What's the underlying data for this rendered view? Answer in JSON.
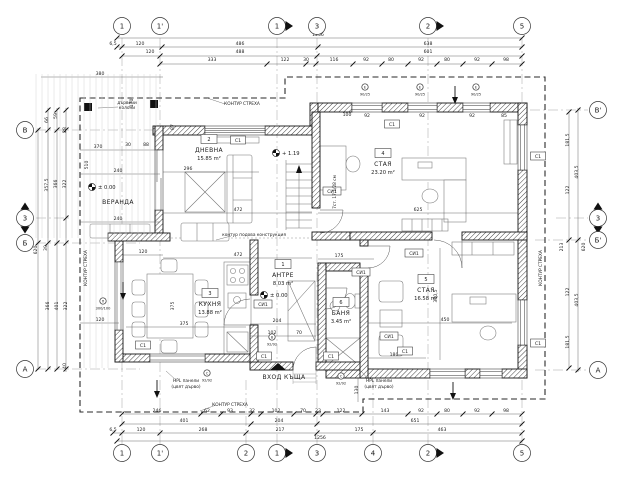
{
  "colors": {
    "paper": "#ffffff",
    "ink": "#1a1a1a"
  },
  "labels": {
    "veranda": "ВЕРАНДА",
    "entrance": "ВХОД КЪЩА",
    "c1": "С1",
    "si1": "СИ1"
  },
  "rooms": [
    {
      "num": "2",
      "name": "ДНЕВНА",
      "area": "15.85 m²",
      "x": 209,
      "y": 141
    },
    {
      "num": "4",
      "name": "СТАЯ",
      "area": "23.20 m²",
      "x": 383,
      "y": 155
    },
    {
      "num": "3",
      "name": "КУХНЯ",
      "area": "13.88 m²",
      "x": 210,
      "y": 295
    },
    {
      "num": "1",
      "name": "АНТРЕ",
      "area": "8.03 m²",
      "x": 283,
      "y": 266
    },
    {
      "num": "6",
      "name": "БАНЯ",
      "area": "3.45 m²",
      "x": 341,
      "y": 304
    },
    {
      "num": "5",
      "name": "СТАЯ",
      "area": "16.58 m²",
      "x": 426,
      "y": 281
    }
  ],
  "axes": {
    "top": [
      {
        "l": "1",
        "x": 122
      },
      {
        "l": "1'",
        "x": 160
      },
      {
        "l": "1",
        "x": 277,
        "s": "h"
      },
      {
        "l": "3",
        "x": 317
      },
      {
        "l": "2",
        "x": 428,
        "s": "h"
      },
      {
        "l": "5",
        "x": 522
      }
    ],
    "bottom": [
      {
        "l": "1",
        "x": 122
      },
      {
        "l": "1'",
        "x": 160
      },
      {
        "l": "2",
        "x": 246
      },
      {
        "l": "1",
        "x": 277,
        "s": "h"
      },
      {
        "l": "3",
        "x": 317
      },
      {
        "l": "4",
        "x": 373
      },
      {
        "l": "2",
        "x": 428,
        "s": "h"
      },
      {
        "l": "5",
        "x": 522
      }
    ],
    "left": [
      {
        "l": "В",
        "y": 130
      },
      {
        "l": "3",
        "y": 218,
        "s": "v"
      },
      {
        "l": "Б",
        "y": 243
      },
      {
        "l": "А",
        "y": 369
      }
    ],
    "right": [
      {
        "l": "В'",
        "y": 110
      },
      {
        "l": "3",
        "y": 218,
        "s": "v"
      },
      {
        "l": "Б'",
        "y": 240
      },
      {
        "l": "А",
        "y": 370
      }
    ]
  },
  "levels": [
    {
      "t": "± 0.00",
      "x": 104,
      "y": 189
    },
    {
      "t": "± 0.00",
      "x": 276,
      "y": 297
    },
    {
      "t": "+ 1.19",
      "x": 288,
      "y": 155
    }
  ],
  "boxes": {
    "c1": [
      [
        238,
        141
      ],
      [
        392,
        125
      ],
      [
        538,
        157
      ],
      [
        538,
        344
      ],
      [
        143,
        346
      ],
      [
        264,
        357
      ],
      [
        331,
        357
      ],
      [
        405,
        352
      ]
    ],
    "si1": [
      [
        332,
        192
      ],
      [
        263,
        305
      ],
      [
        361,
        273
      ],
      [
        389,
        337
      ],
      [
        414,
        254
      ]
    ]
  },
  "tags": [
    {
      "l": "Е",
      "n": "90/25",
      "x": 365,
      "y": 91
    },
    {
      "l": "Е",
      "n": "90/25",
      "x": 420,
      "y": 91
    },
    {
      "l": "Е",
      "n": "90/25",
      "x": 476,
      "y": 91
    },
    {
      "l": "В",
      "n": "92/92",
      "x": 272,
      "y": 341
    },
    {
      "l": "С",
      "n": "92/92",
      "x": 207,
      "y": 377
    },
    {
      "l": "С",
      "n": "92/92",
      "x": 341,
      "y": 380
    },
    {
      "l": "П",
      "n": "300/100",
      "x": 103,
      "y": 305
    }
  ],
  "annotations": [
    {
      "t": "КОНТУР СТРЕХА",
      "x": 242,
      "y": 105
    },
    {
      "t": "КОНТУР СТРЕХА",
      "x": 230,
      "y": 406
    },
    {
      "t": "КОНТУР СТРЕХА",
      "x": 87,
      "y": 268,
      "r": -90
    },
    {
      "t": "КОНТУР СТРЕХА",
      "x": 542,
      "y": 268,
      "r": -90
    },
    {
      "t": "контур подова конструкция",
      "x": 254,
      "y": 236
    },
    {
      "t": "дървени",
      "x": 127,
      "y": 104
    },
    {
      "t": "колони",
      "x": 127,
      "y": 109
    },
    {
      "t": "HPL панели",
      "x": 186,
      "y": 382
    },
    {
      "t": "(цвят дърво)",
      "x": 186,
      "y": 388
    },
    {
      "t": "HPL панели",
      "x": 379,
      "y": 382
    },
    {
      "t": "(цвят дърво)",
      "x": 379,
      "y": 388
    },
    {
      "t": "7ст. 17.1/28 см",
      "x": 336,
      "y": 192,
      "r": -90
    }
  ],
  "dims": [
    {
      "t": "1256",
      "x": 318,
      "y": 36
    },
    {
      "t": "6,5",
      "x": 113,
      "y": 45
    },
    {
      "t": "120",
      "x": 140,
      "y": 45
    },
    {
      "t": "486",
      "x": 240,
      "y": 45
    },
    {
      "t": "638",
      "x": 428,
      "y": 45
    },
    {
      "t": "120",
      "x": 150,
      "y": 53
    },
    {
      "t": "488",
      "x": 240,
      "y": 53
    },
    {
      "t": "601",
      "x": 428,
      "y": 53
    },
    {
      "t": "333",
      "x": 212,
      "y": 61
    },
    {
      "t": "122",
      "x": 285,
      "y": 61
    },
    {
      "t": "30",
      "x": 306,
      "y": 61
    },
    {
      "t": "116",
      "x": 334,
      "y": 61
    },
    {
      "t": "92",
      "x": 366,
      "y": 61
    },
    {
      "t": "80",
      "x": 391,
      "y": 61
    },
    {
      "t": "92",
      "x": 421,
      "y": 61
    },
    {
      "t": "80",
      "x": 447,
      "y": 61
    },
    {
      "t": "92",
      "x": 477,
      "y": 61
    },
    {
      "t": "98",
      "x": 506,
      "y": 61
    },
    {
      "t": "246",
      "x": 157,
      "y": 412
    },
    {
      "t": "62",
      "x": 207,
      "y": 412
    },
    {
      "t": "93",
      "x": 230,
      "y": 412
    },
    {
      "t": "32",
      "x": 252,
      "y": 412
    },
    {
      "t": "102",
      "x": 276,
      "y": 412
    },
    {
      "t": "70",
      "x": 303,
      "y": 412
    },
    {
      "t": "23",
      "x": 318,
      "y": 412
    },
    {
      "t": "122",
      "x": 341,
      "y": 412
    },
    {
      "t": "143",
      "x": 385,
      "y": 412
    },
    {
      "t": "92",
      "x": 421,
      "y": 412
    },
    {
      "t": "80",
      "x": 447,
      "y": 412
    },
    {
      "t": "92",
      "x": 477,
      "y": 412
    },
    {
      "t": "98",
      "x": 506,
      "y": 412
    },
    {
      "t": "401",
      "x": 184,
      "y": 422
    },
    {
      "t": "204",
      "x": 279,
      "y": 422
    },
    {
      "t": "651",
      "x": 415,
      "y": 422
    },
    {
      "t": "6,5",
      "x": 113,
      "y": 431
    },
    {
      "t": "120",
      "x": 141,
      "y": 431
    },
    {
      "t": "268",
      "x": 203,
      "y": 431
    },
    {
      "t": "217",
      "x": 280,
      "y": 431
    },
    {
      "t": "175",
      "x": 359,
      "y": 431
    },
    {
      "t": "463",
      "x": 442,
      "y": 431
    },
    {
      "t": "1256",
      "x": 320,
      "y": 439
    },
    {
      "t": "66",
      "x": 48,
      "y": 120,
      "r": -90
    },
    {
      "t": "59",
      "x": 57,
      "y": 116,
      "r": -90
    },
    {
      "t": "28",
      "x": 66,
      "y": 130,
      "r": -90
    },
    {
      "t": "357,5",
      "x": 48,
      "y": 185,
      "r": -90
    },
    {
      "t": "366",
      "x": 57,
      "y": 184,
      "r": -90
    },
    {
      "t": "322",
      "x": 66,
      "y": 184,
      "r": -90
    },
    {
      "t": "366",
      "x": 49,
      "y": 306,
      "r": -90
    },
    {
      "t": "401",
      "x": 58,
      "y": 306,
      "r": -90
    },
    {
      "t": "322",
      "x": 67,
      "y": 306,
      "r": -90
    },
    {
      "t": "40",
      "x": 66,
      "y": 366,
      "r": -90
    },
    {
      "t": "39",
      "x": 47,
      "y": 248,
      "r": -90
    },
    {
      "t": "620",
      "x": 37,
      "y": 250,
      "r": -90
    },
    {
      "t": "380",
      "x": 100,
      "y": 75
    },
    {
      "t": "170",
      "x": 133,
      "y": 103,
      "r": -90
    },
    {
      "t": "370",
      "x": 98,
      "y": 148
    },
    {
      "t": "510",
      "x": 88,
      "y": 165,
      "r": -90
    },
    {
      "t": "240",
      "x": 118,
      "y": 172
    },
    {
      "t": "240",
      "x": 118,
      "y": 220
    },
    {
      "t": "30",
      "x": 128,
      "y": 146
    },
    {
      "t": "88",
      "x": 146,
      "y": 146
    },
    {
      "t": "87",
      "x": 174,
      "y": 127,
      "r": -90
    },
    {
      "t": "120",
      "x": 143,
      "y": 253
    },
    {
      "t": "120",
      "x": 100,
      "y": 321
    },
    {
      "t": "181,5",
      "x": 569,
      "y": 140,
      "r": -90
    },
    {
      "t": "122",
      "x": 569,
      "y": 190,
      "r": -90
    },
    {
      "t": "122",
      "x": 569,
      "y": 292,
      "r": -90
    },
    {
      "t": "181,5",
      "x": 569,
      "y": 342,
      "r": -90
    },
    {
      "t": "403,5",
      "x": 578,
      "y": 172,
      "r": -90
    },
    {
      "t": "403,5",
      "x": 578,
      "y": 300,
      "r": -90
    },
    {
      "t": "213",
      "x": 563,
      "y": 247,
      "r": -90
    },
    {
      "t": "620",
      "x": 585,
      "y": 247,
      "r": -90
    },
    {
      "t": "296",
      "x": 188,
      "y": 170
    },
    {
      "t": "472",
      "x": 238,
      "y": 211
    },
    {
      "t": "472",
      "x": 238,
      "y": 256
    },
    {
      "t": "625",
      "x": 418,
      "y": 211
    },
    {
      "t": "375",
      "x": 174,
      "y": 306,
      "r": -90
    },
    {
      "t": "375",
      "x": 184,
      "y": 325
    },
    {
      "t": "204",
      "x": 277,
      "y": 322
    },
    {
      "t": "102",
      "x": 272,
      "y": 334
    },
    {
      "t": "70",
      "x": 299,
      "y": 334
    },
    {
      "t": "175",
      "x": 339,
      "y": 257
    },
    {
      "t": "450",
      "x": 445,
      "y": 321
    },
    {
      "t": "180",
      "x": 394,
      "y": 356
    },
    {
      "t": "380,5",
      "x": 437,
      "y": 296,
      "r": -90
    },
    {
      "t": "130",
      "x": 358,
      "y": 390,
      "r": -90
    },
    {
      "t": "100",
      "x": 347,
      "y": 116
    },
    {
      "t": "92",
      "x": 367,
      "y": 117
    },
    {
      "t": "92",
      "x": 422,
      "y": 117
    },
    {
      "t": "92",
      "x": 472,
      "y": 117
    },
    {
      "t": "85",
      "x": 504,
      "y": 117
    }
  ]
}
